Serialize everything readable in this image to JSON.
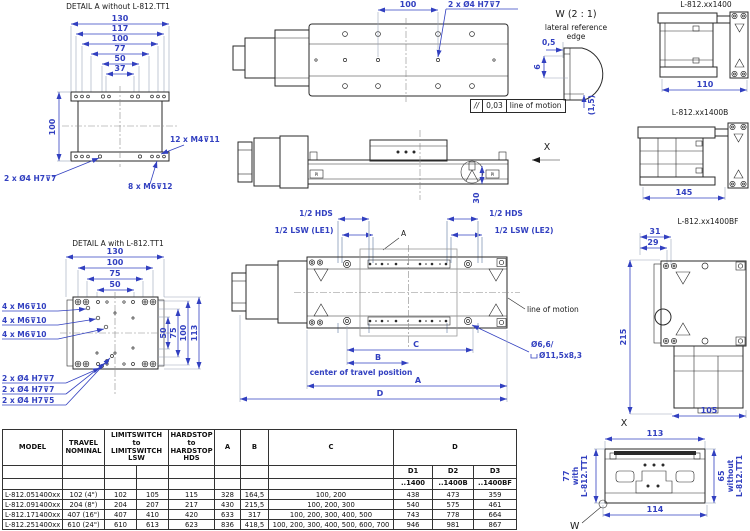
{
  "colors": {
    "dim_blue": "#3240c0",
    "line_dark": "#2a2a2a"
  },
  "detail_top": {
    "title": "DETAIL A  without L-812.TT1",
    "dim_chain": [
      "130",
      "117",
      "100",
      "77",
      "50",
      "37"
    ],
    "dim_height": "100",
    "note_m4": "12 x M4⊽11",
    "note_h7": "2 x Ø4 H7⊽7",
    "note_m6": "8 x M6⊽12"
  },
  "top_view": {
    "dim_100": "100",
    "note_h7": "2 x Ø4 H7⊽7"
  },
  "tolerance_frame": {
    "symbol": "//",
    "value": "0,03",
    "note": "line of motion"
  },
  "w_detail": {
    "title": "W (2 : 1)",
    "sub1": "lateral reference",
    "sub2": "edge",
    "dim_05": "0,5",
    "dim_6": "6",
    "dim_15": "(1,5)"
  },
  "view_1400": {
    "label": "L-812.xx1400",
    "dim_110": "110"
  },
  "view_1400b": {
    "label": "L-812.xx1400B",
    "dim_145": "145"
  },
  "side_view": {
    "x_label": "X",
    "dim_30": "30",
    "logo": "PI"
  },
  "detail_bottom": {
    "title": "DETAIL A  with L-812.TT1",
    "dim_chain_top": [
      "130",
      "100",
      "75",
      "50"
    ],
    "dim_chain_right": [
      "50",
      "75",
      "100",
      "113"
    ],
    "notes_left": [
      "4 x M6⊽10",
      "4 x M6⊽10",
      "4 x M6⊽10"
    ],
    "notes_bottom": [
      "2 x Ø4 H7⊽7",
      "2 x Ø4 H7⊽7",
      "2 x Ø4 H7⊽5"
    ]
  },
  "main_view": {
    "hds_left": "1/2 HDS",
    "lsw_left": "1/2 LSW (LE1)",
    "hds_right": "1/2 HDS",
    "lsw_right": "1/2 LSW (LE2)",
    "a_callout": "A",
    "line_of_motion": "line of motion",
    "hole_note_line1": "Ø6,6/",
    "hole_note_line2": "Ø11,5x8,3",
    "dim_c": "C",
    "dim_b": "B",
    "dim_a": "A",
    "dim_d": "D",
    "center_note": "center of travel position"
  },
  "view_1400bf": {
    "label": "L-812.xx1400BF",
    "dim_31": "31",
    "dim_29": "29",
    "dim_215": "215",
    "dim_105": "105"
  },
  "x_view": {
    "label": "X",
    "dim_113": "113",
    "dim_114": "114",
    "left_dim": "77",
    "left_note1": "with",
    "left_note2": "L-812.TT1",
    "right_dim": "65",
    "right_note1": "without",
    "right_note2": "L-812.TT1",
    "w_label": "W"
  },
  "table": {
    "h_model": "MODEL",
    "h_travel": "TRAVEL\nNOMINAL",
    "h_lsw": "LIMITSWITCH\nto\nLIMITSWITCH\nLSW",
    "h_hds": "HARDSTOP\nto\nHARDSTOP\nHDS",
    "h_a": "A",
    "h_b": "B",
    "h_c": "C",
    "h_d": "D",
    "h_d1": "D1",
    "h_d2": "D2",
    "h_d3": "D3",
    "h_s1": "..1400",
    "h_s2": "..1400B",
    "h_s3": "..1400BF",
    "rows": [
      {
        "model": "L-812.051400xx",
        "travel": "102 (4\")",
        "lsw1": "102",
        "lsw2": "105",
        "hds": "115",
        "a": "328",
        "b": "164,5",
        "c": "100, 200",
        "d1": "438",
        "d2": "473",
        "d3": "359"
      },
      {
        "model": "L-812.091400xx",
        "travel": "204 (8\")",
        "lsw1": "204",
        "lsw2": "207",
        "hds": "217",
        "a": "430",
        "b": "215,5",
        "c": "100, 200, 300",
        "d1": "540",
        "d2": "575",
        "d3": "461"
      },
      {
        "model": "L-812.171400xx",
        "travel": "407 (16\")",
        "lsw1": "407",
        "lsw2": "410",
        "hds": "420",
        "a": "633",
        "b": "317",
        "c": "100, 200, 300, 400, 500",
        "d1": "743",
        "d2": "778",
        "d3": "664"
      },
      {
        "model": "L-812.251400xx",
        "travel": "610 (24\")",
        "lsw1": "610",
        "lsw2": "613",
        "hds": "623",
        "a": "836",
        "b": "418,5",
        "c": "100, 200, 300, 400, 500, 600, 700",
        "d1": "946",
        "d2": "981",
        "d3": "867"
      }
    ]
  }
}
